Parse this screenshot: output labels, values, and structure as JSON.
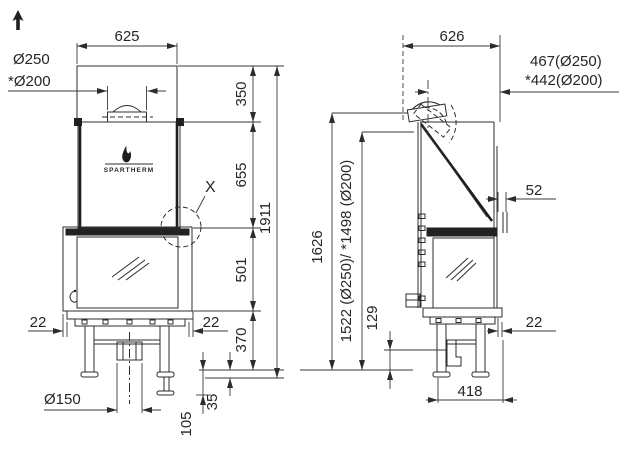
{
  "front_view": {
    "brand": "SPARTHERM",
    "detail_marker": "X",
    "dims": {
      "width_top": "625",
      "flue_collar_dia": "Ø250",
      "flue_collar_dia_alt": "*Ø200",
      "hood_height": "350",
      "firebox_height": "655",
      "door_height": "501",
      "base_height": "370",
      "overall_height": "1911",
      "side_overhang_left": "22",
      "side_overhang_right": "22",
      "air_intake_dia": "Ø150",
      "foot_clearance": "105",
      "foot_adjust": "35"
    }
  },
  "side_view": {
    "dims": {
      "depth_top": "626",
      "flue_axis_offset": "467(Ø250)",
      "flue_axis_offset_alt": "*442(Ø200)",
      "rear_gap": "52",
      "overall_height": "1626",
      "flue_axis_height": "1522 (Ø250)/ *1498 (Ø200)",
      "intake_height": "129",
      "rear_overhang": "22",
      "base_depth": "418"
    }
  },
  "icons": {
    "orientation_arrow": "up-arrow",
    "brand_mark": "flame"
  },
  "colors": {
    "line": "#2c2c2c",
    "text": "#262626",
    "background": "#ffffff"
  }
}
